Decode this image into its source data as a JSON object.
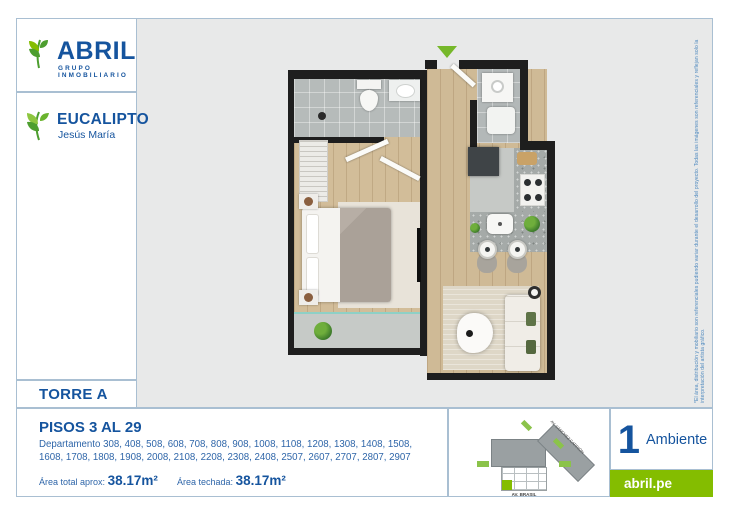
{
  "brand": {
    "name": "ABRIL",
    "tagline": "GRUPO INMOBILIARIO",
    "blue": "#15549e",
    "green": "#84bd00"
  },
  "project": {
    "name": "EUCALIPTO",
    "district": "Jesús María"
  },
  "tower": {
    "label": "TORRE A"
  },
  "floors": {
    "title": "PISOS 3 AL 29",
    "departments": "Departamento 308, 408, 508, 608, 708, 808, 908, 1008, 1108, 1208, 1308, 1408, 1508, 1608, 1708, 1808, 1908, 2008, 2108, 2208, 2308, 2408, 2507, 2607, 2707, 2807, 2907",
    "area_total_label": "Área total aprox:",
    "area_total_value": "38.17m²",
    "area_roofed_label": "Área techada:",
    "area_roofed_value": "38.17m²"
  },
  "unit": {
    "count": "1",
    "count_label": "Ambiente",
    "website": "abril.pe"
  },
  "siteplan": {
    "street_diagonal": "AV. SÁNCHEZ CARRIÓN",
    "street_bottom": "AV. BRASIL"
  },
  "disclaimer": "*El área, distribución y mobiliario son referenciales pudiendo variar durante el desarrollo del proyecto. Todas las imágenes son referenciales y reflejan solo la interpretación del artista gráfico.",
  "floorplan": {
    "wall_color": "#1e1e1e",
    "wood_color": "#cfba96",
    "tile_color": "#b6bbba",
    "counter_color": "#a5aaa8",
    "entrance_arrow_color": "#76b82a"
  }
}
